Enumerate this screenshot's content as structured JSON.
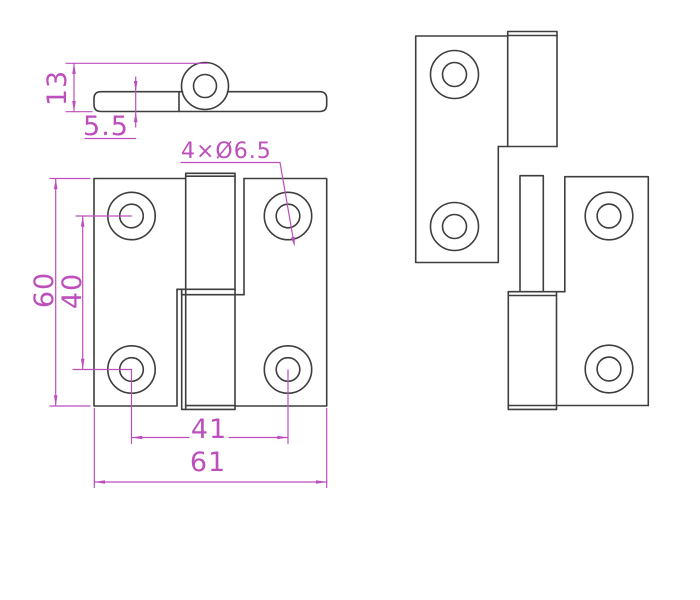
{
  "drawing": {
    "kind": "hinge-technical-drawing",
    "colors": {
      "background": "#ffffff",
      "outline": "#3e3e3e",
      "dimension": "#bc4fbc"
    },
    "views": {
      "side_view": {
        "name": "side-profile-view",
        "dimensions": {
          "overall_thickness": "13",
          "leaf_thickness": "5.5"
        }
      },
      "front_view": {
        "name": "assembled-front-view",
        "dimensions": {
          "hole_callout": "4×Ø6.5",
          "overall_height": "60",
          "hole_spacing_vertical": "40",
          "hole_spacing_horizontal": "41",
          "overall_width": "61"
        }
      },
      "exploded_view": {
        "name": "separated-leaves-view"
      }
    }
  }
}
